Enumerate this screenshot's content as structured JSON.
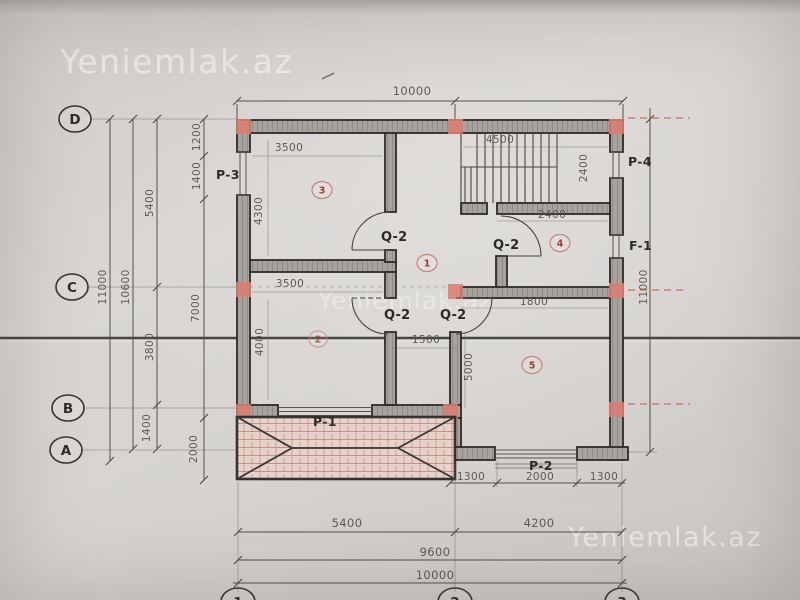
{
  "watermark": {
    "text": "Yeniemlak.az"
  },
  "grid": {
    "d": "D",
    "c": "C",
    "b": "B",
    "a": "A",
    "c1": "1",
    "c2": "2",
    "c3": "3"
  },
  "dims": {
    "top_overall": "10000",
    "right_overall": "11000",
    "left_overall": "11000",
    "left_10600": "10600",
    "left_5400": "5400",
    "left_3800": "3800",
    "left_1400": "1400",
    "left_1200": "1200",
    "left_1400b": "1400",
    "left_7000": "7000",
    "left_2000": "2000",
    "room3_w": "3500",
    "room3_h": "4300",
    "stair_top": "4500",
    "stair_w": "2400",
    "room4_top": "2400",
    "room4_bottom": "1800",
    "room2_top": "3500",
    "room2_h": "4000",
    "hall_w": "1500",
    "room5_h": "5000",
    "bottom_5400": "5400",
    "bottom_4200": "4200",
    "bottom_9600": "9600",
    "bottom_10000": "10000",
    "veranda_1300a": "1300",
    "veranda_2000": "2000",
    "veranda_1300b": "1300"
  },
  "labels": {
    "p1": "P-1",
    "p2": "P-2",
    "p3": "P-3",
    "p4": "P-4",
    "f1": "F-1",
    "q2": "Q-2"
  },
  "rooms": {
    "r1": "1",
    "r2": "2",
    "r3": "3",
    "r4": "4",
    "r5": "5"
  }
}
